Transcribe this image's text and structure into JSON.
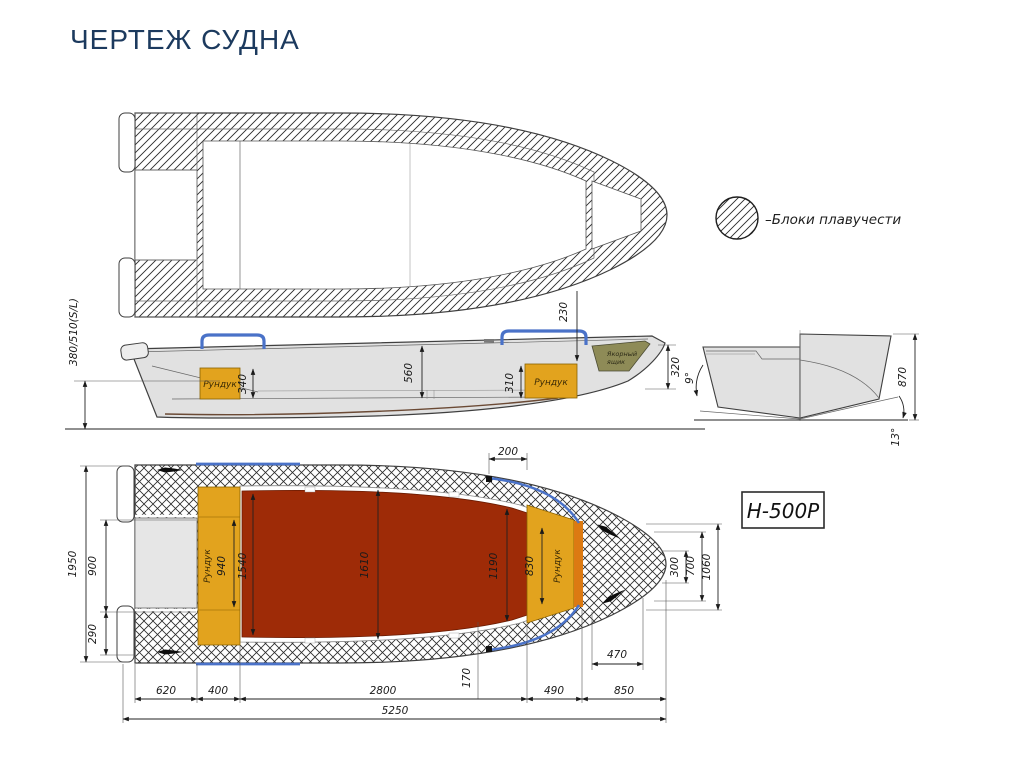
{
  "title": "ЧЕРТЕЖ СУДНА",
  "model": "Н-500Р",
  "legend_label": "–Блоки плавучести",
  "labels": {
    "locker": "Рундук",
    "anchor1": "Якорный",
    "anchor2": "ящик"
  },
  "side": {
    "transom_height": "380/510(S/L)",
    "aft_locker_h": "340",
    "cockpit_depth": "560",
    "fwd_locker_h": "310",
    "bow_deck": "230",
    "bow_height": "320"
  },
  "section": {
    "height": "870",
    "deadrise": "13°",
    "transom_angle": "9°"
  },
  "plan": {
    "beam": "1950",
    "well_width": "900",
    "side_width": "290",
    "aft_block": "620",
    "aft_locker_w": "400",
    "cockpit_len": "2800",
    "fwd_len": "490",
    "bow_len": "850",
    "overall_len": "5250",
    "floor_offset": "170",
    "bow_block_len": "470",
    "aft_locker_l": "940",
    "floor_aft": "1540",
    "floor_mid": "1610",
    "floor_fwd": "1190",
    "fwd_locker_l": "830",
    "bow_tip_w": "300",
    "bow_w": "700",
    "bow_max_w": "1060",
    "rail_len": "200"
  }
}
